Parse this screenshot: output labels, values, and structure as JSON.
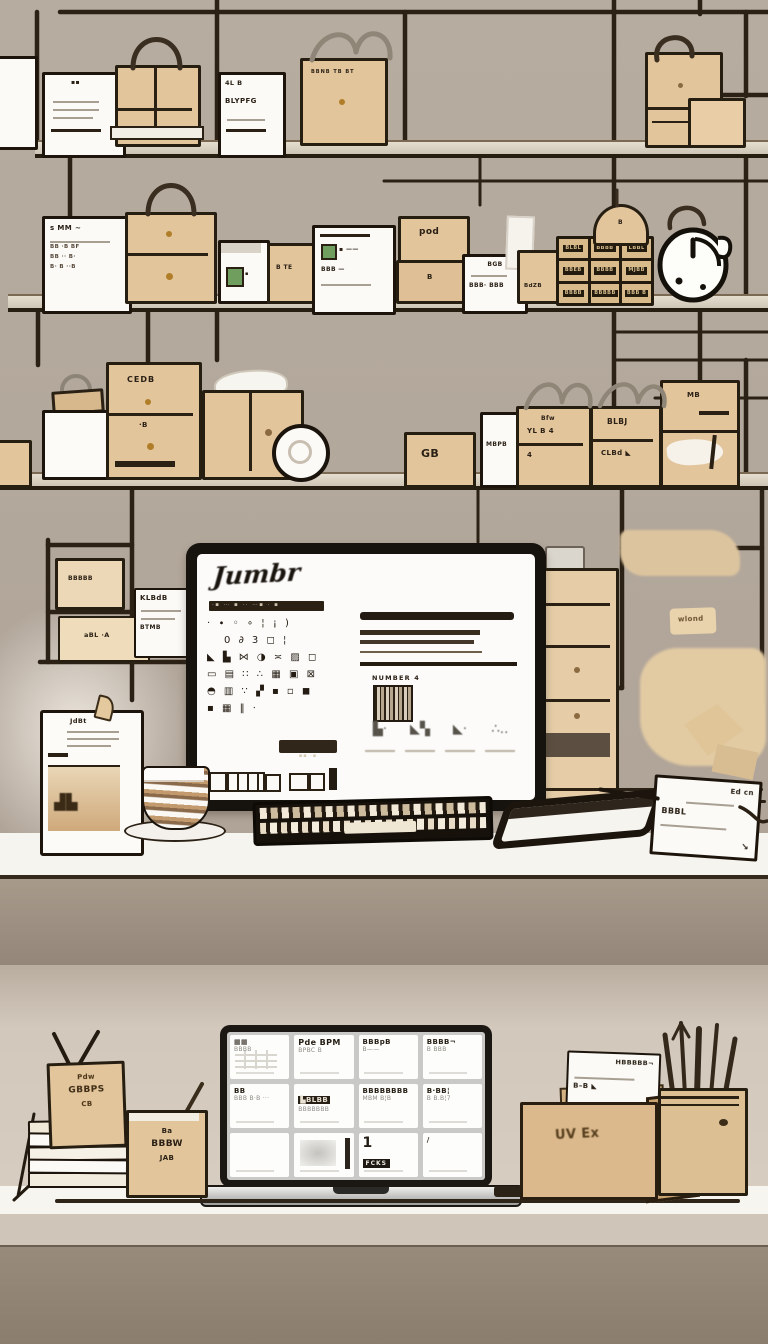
{
  "scene": {
    "alt": "Hand-drawn beige illustration of a parcel-packing workspace: wall grid shelves full of cardboard boxes and white labels, a desktop computer on a white desk with keyboard, coffee cup and tablet, and below a second counter with a laptop, paper stack, open parcel and pen cup",
    "colors": {
      "wall_upper": "#b3a89c",
      "wall_lower": "#d1c7bb",
      "ink": "#271e12",
      "cardboard": "#e3c59c",
      "cardboard_dark": "#c5a274",
      "desk_white": "#f6f4ef",
      "desk_front": "#a09182",
      "bottom_front": "#8d7e6e",
      "accent_green": "#6f9e5f",
      "knob_gold": "#b07d28"
    }
  },
  "row1": {
    "card_a_mark": "▪▪",
    "card_b": {
      "line1": "4L B",
      "line2": "BLYPFG"
    },
    "ribbon_box": {
      "label": "BBNB TB BT"
    }
  },
  "row2": {
    "card_a": {
      "heading": "s MM ~",
      "r1": "BB ·B BF",
      "r2": "BB ·· B·",
      "r3": "B· B ··B"
    },
    "green_box": {
      "label": "▪"
    },
    "small_box": {
      "label": "B TE"
    },
    "card_b": {
      "r1": "▪ ——",
      "r2": "BBB —"
    },
    "pod_box": {
      "label": "pod"
    },
    "pod_box2": {
      "label": "B"
    },
    "card_c": {
      "r1": "BGB",
      "r2": "BBB· BBB"
    },
    "xs_box": {
      "label": "BdZB"
    },
    "cabinet": {
      "labels": [
        "BLBL",
        "BBBB",
        "LBBL",
        "BBEB",
        "BBBB",
        "MJBB",
        "BBBB",
        "BBBBB",
        "BBB B"
      ]
    },
    "hang_tag": {
      "label": "B"
    }
  },
  "row3": {
    "cedb_box": {
      "top": "CEDB",
      "low": "·B"
    },
    "gb_box": {
      "label": "GB"
    },
    "slip": {
      "label": "MBPB"
    },
    "ylb_box": {
      "top": "Bfw",
      "mid": "YL B 4",
      "low": "4"
    },
    "blbj_box": {
      "top": "BLBJ",
      "low": "CLBd ◣"
    },
    "corner_box": {
      "label": "MB"
    }
  },
  "mid": {
    "mini_upper": "BBBBB",
    "mini_lower": "aBL ·A",
    "mini_card": {
      "title": "KLBdB",
      "sub": "BTMB"
    },
    "wlond_tag": "wlond"
  },
  "monitor": {
    "logo": "Jumbr",
    "nav_glyphs": "·▪ ⋯ ▪ ·· ⋯▪ · ▪",
    "icon_rows": [
      "· ∙ ◦ ∘ ¦ ¡ )",
      "   0 ∂ 3 ◻ ¦",
      "◣ ▙ ⋈ ◑ ≍ ▨ ◻",
      "▭ ▤ ∷ ∴ ▦ ▣ ⊠",
      "◓ ▥ ∵ ▞ ▪ ▫ ◼",
      "▪ ▦ ‖ ⋅"
    ],
    "button_glyphs": "▪▪ ·▪",
    "barcode_label": "NUMBER 4",
    "thumbs": [
      "▙·",
      "◣▚",
      "◣·",
      "∴‥"
    ]
  },
  "desk": {
    "stand_card": {
      "title": "JdBt",
      "img": "▟▙"
    },
    "notepad": {
      "title": "Ed cn",
      "label": "BBBL",
      "arrow": "↘"
    }
  },
  "lower": {
    "tan_card": {
      "l1": "Pdw",
      "l2": "GBBPS",
      "l3": "CB"
    },
    "small_box": {
      "l1": "Ba",
      "l2": "BBBW",
      "l3": "JAB"
    },
    "open_box": {
      "label": "UV Ex"
    },
    "box_card": {
      "l1": "HBBBBB¬",
      "l2": "B–B ◣"
    },
    "laptop": {
      "cells": [
        {
          "t": "▦▦",
          "s": "BBBB"
        },
        {
          "t": "Pde BPM",
          "s": "BPBC B"
        },
        {
          "t": "BBBpB",
          "s": "B——"
        },
        {
          "t": "BBBB¬",
          "s": "B BBB"
        },
        {
          "t": "BB",
          "s": "BBB B·B ···"
        },
        {
          "t": "▙BLBB",
          "s": "BBBBBBB"
        },
        {
          "t": "BBBBBBBB",
          "s": "MBM B¦B"
        },
        {
          "t": "B·BB¦",
          "s": "B B.B¦7"
        },
        {
          "t": "",
          "s": ""
        },
        {
          "t": "",
          "s": ""
        },
        {
          "t": "1",
          "s": "FCKS"
        },
        {
          "t": "/",
          "s": ""
        }
      ]
    }
  }
}
